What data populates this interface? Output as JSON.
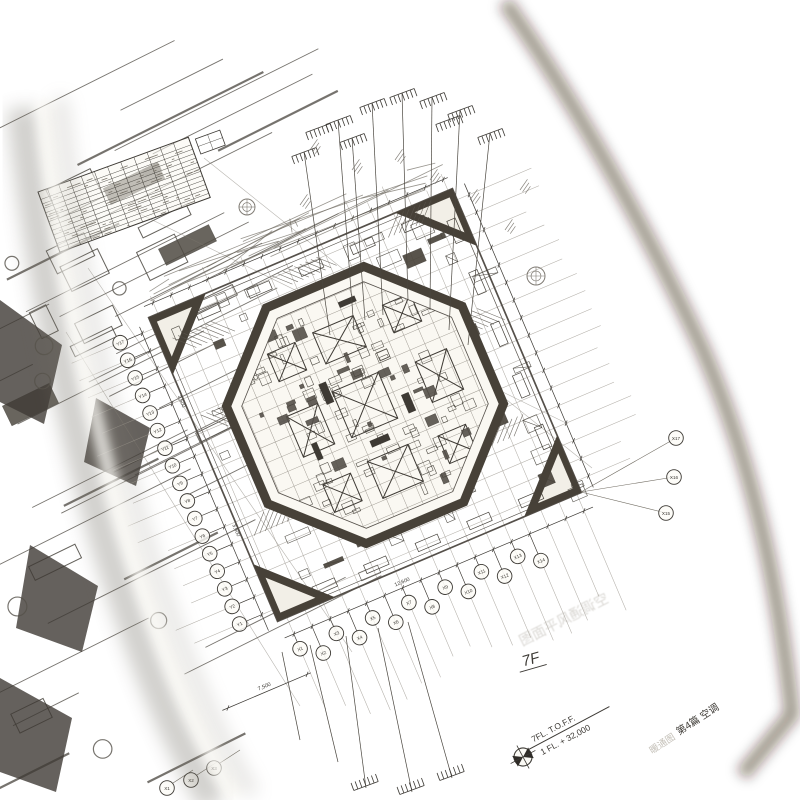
{
  "scene": {
    "description_colors": {
      "table": "#8d4a36",
      "table_light": "#a25b44",
      "table_dark": "#632e1d",
      "corner_paper": "#ecd8c9",
      "page": "#f5f2ea",
      "ink": "#3c3934",
      "ink_light": "#8a857c",
      "dark_fill": "#474138",
      "ghost": "#a8a399"
    }
  },
  "drawing": {
    "floor_title": "7F",
    "elevation_marker": {
      "line1": "7FL. T.O.F.F.",
      "line2": "1 FL. + 32,000"
    },
    "footer": {
      "ghost_prefix": "暖通图",
      "chapter": "第4篇 空调"
    },
    "ghost_showthrough": "空调通风平面图",
    "grid": {
      "y_labels": [
        "Y17",
        "Y16",
        "Y15",
        "Y14",
        "Y13",
        "Y12",
        "Y11",
        "Y10",
        "Y9",
        "Y8",
        "Y7",
        "Y6",
        "Y5",
        "Y4",
        "Y3",
        "Y2",
        "Y1"
      ],
      "x_labels": [
        "X1",
        "X2",
        "X3",
        "X4",
        "X5",
        "X6",
        "X7",
        "X8",
        "X9",
        "X10",
        "X11",
        "X12",
        "X13",
        "X14",
        "X15",
        "X16",
        "X17"
      ],
      "extra_labels": [
        "X1",
        "X2",
        "X3"
      ]
    },
    "dimensions": {
      "left": [
        "3,600",
        "3,600"
      ],
      "bottom": [
        "12,600"
      ],
      "lower": [
        "7,500"
      ]
    }
  }
}
